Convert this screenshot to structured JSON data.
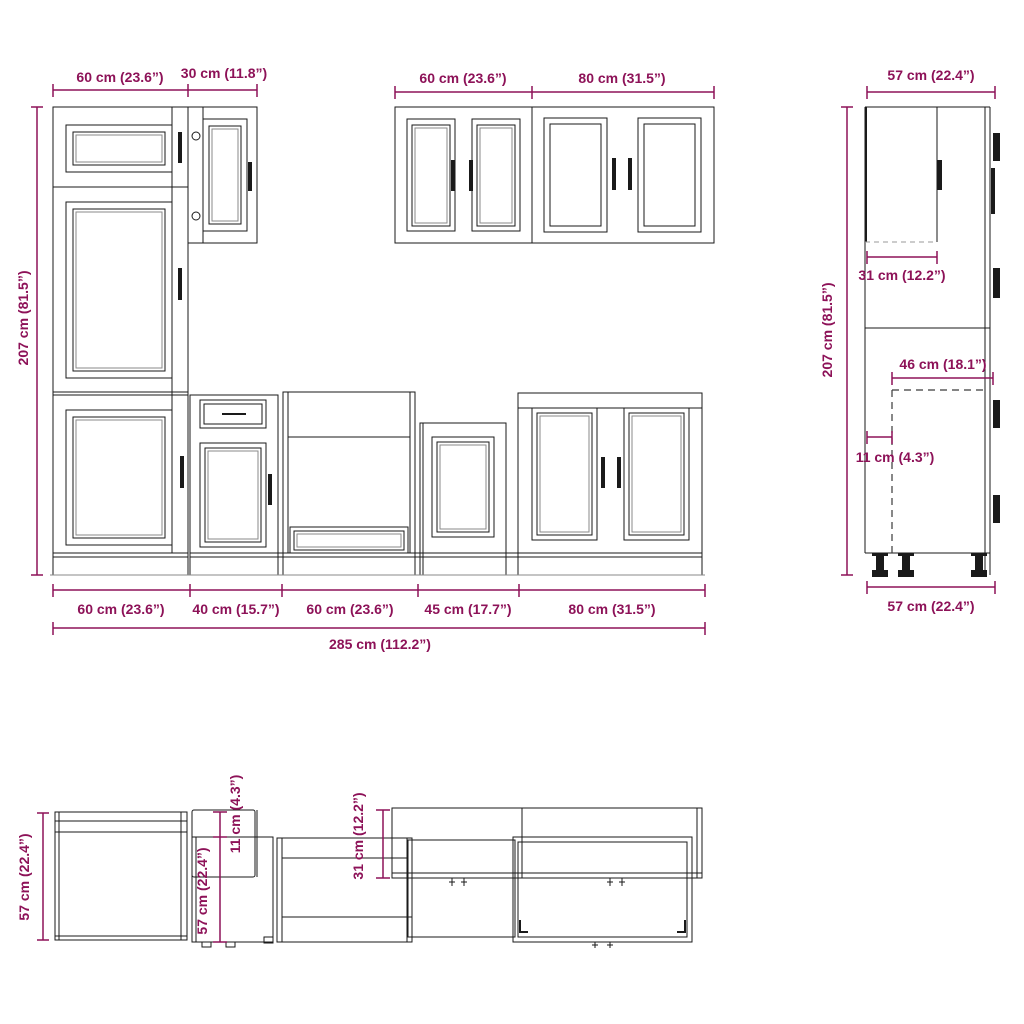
{
  "title": "Kitchen cabinet set technical drawing",
  "colors": {
    "dimension": "#8D1258",
    "line": "#1a1a1a"
  },
  "front_view": {
    "tall_unit_width": "60 cm (23.6”)",
    "upper_30_width": "30 cm (11.8”)",
    "upper_60_width": "60 cm (23.6”)",
    "upper_80_width": "80 cm (31.5”)",
    "total_height": "207 cm (81.5”)",
    "base_widths": [
      "60 cm (23.6”)",
      "40 cm (15.7”)",
      "60 cm (23.6”)",
      "45 cm (17.7”)",
      "80 cm (31.5”)"
    ],
    "total_width": "285 cm (112.2”)"
  },
  "side_view": {
    "top_depth": "57 cm (22.4”)",
    "total_height": "207 cm (81.5”)",
    "upper_door_depth": "31 cm (12.2”)",
    "carcass_depth": "46 cm (18.1”)",
    "front_offset": "11 cm (4.3”)",
    "bottom_depth": "57 cm (22.4”)"
  },
  "top_view": {
    "left_unit_depth": "57 cm (22.4”)",
    "mid_unit_depth": "57 cm (22.4”)",
    "side_panel_offset": "11 cm (4.3”)",
    "upper_unit_depth": "31 cm (12.2”)"
  }
}
